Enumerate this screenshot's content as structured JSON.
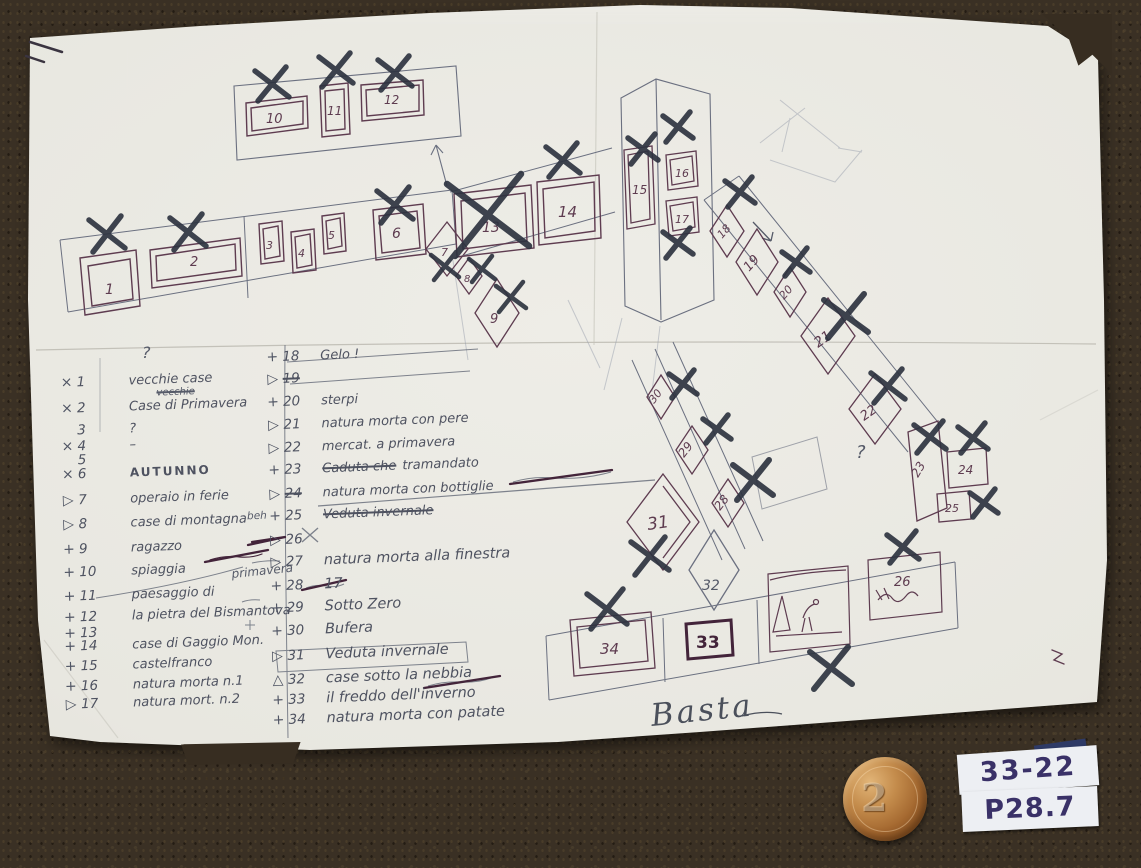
{
  "notes": {
    "q1": "?",
    "q2": "?",
    "primavera": "primavera",
    "basta": "Basta"
  },
  "coin": {
    "value": "2"
  },
  "corner_sticker": {
    "line1": "33-22",
    "line2": "P28.7"
  },
  "left_list": {
    "items": [
      {
        "mark": "×",
        "num": "1",
        "text": "vecchie case"
      },
      {
        "mark": "×",
        "num": "2",
        "text": "Case di Primavera",
        "note_above": "vecchie"
      },
      {
        "mark": "",
        "num": "3",
        "text": "?"
      },
      {
        "mark": "×",
        "num": "4",
        "text": "–"
      },
      {
        "mark": "",
        "num": "5",
        "text": ""
      },
      {
        "mark": "×",
        "num": "6",
        "text": "AUTUNNO"
      },
      {
        "mark": "▷",
        "num": "7",
        "text": "operaio in ferie"
      },
      {
        "mark": "▷",
        "num": "8",
        "text": "case di montagna"
      },
      {
        "mark": "+",
        "num": "9",
        "text": "ragazzo"
      },
      {
        "mark": "+",
        "num": "10",
        "text": "spiaggia"
      },
      {
        "mark": "+",
        "num": "11",
        "text": "paesaggio di"
      },
      {
        "mark": "+",
        "num": "12",
        "text": "la pietra del Bismantova"
      },
      {
        "mark": "+",
        "num": "13",
        "text": ""
      },
      {
        "mark": "+",
        "num": "14",
        "text": "case di Gaggio Mon."
      },
      {
        "mark": "+",
        "num": "15",
        "text": "castelfranco"
      },
      {
        "mark": "+",
        "num": "16",
        "text": "natura morta n.1"
      },
      {
        "mark": "▷",
        "num": "17",
        "text": "natura mort. n.2"
      }
    ]
  },
  "middle_list": {
    "items": [
      {
        "mark": "+",
        "num": "18",
        "text": "Gelo !"
      },
      {
        "mark": "▷",
        "num": "19",
        "text": "",
        "struck": true
      },
      {
        "mark": "+",
        "num": "20",
        "text": "sterpi"
      },
      {
        "mark": "▷",
        "num": "21",
        "text": "natura morta con pere"
      },
      {
        "mark": "▷",
        "num": "22",
        "text": "mercat. a primavera"
      },
      {
        "mark": "+",
        "num": "23",
        "text": "tramandato",
        "crossed_prefix": "Caduta che"
      },
      {
        "mark": "▷",
        "num": "24",
        "text": "natura morta con bottiglie",
        "num_struck": true
      },
      {
        "mark": "+",
        "num": "25",
        "text": "Veduta invernale",
        "struck": true,
        "note_left": "beh"
      },
      {
        "mark": "▷",
        "num": "26",
        "text": ""
      },
      {
        "mark": "▷",
        "num": "27",
        "text": "natura morta alla finestra"
      },
      {
        "mark": "+",
        "num": "28",
        "text": "17"
      },
      {
        "mark": "+",
        "num": "29",
        "text": "Sotto Zero"
      },
      {
        "mark": "+",
        "num": "30",
        "text": "Bufera"
      },
      {
        "mark": "▷",
        "num": "31",
        "text": "Veduta invernale",
        "boxed": true
      },
      {
        "mark": "△",
        "num": "32",
        "text": "case sotto la nebbia"
      },
      {
        "mark": "+",
        "num": "33",
        "text": "il freddo dell'inverno"
      },
      {
        "mark": "+",
        "num": "34",
        "text": "natura morta con patate"
      }
    ]
  },
  "frames": {
    "f1": "1",
    "f2": "2",
    "f3": "3",
    "f4": "4",
    "f5": "5",
    "f6": "6",
    "f7": "7",
    "f8": "8",
    "f9": "9",
    "f10": "10",
    "f11": "11",
    "f12": "12",
    "f13": "13",
    "f14": "14",
    "f15": "15",
    "f16": "16",
    "f17": "17",
    "f18": "18",
    "f19": "19",
    "f20": "20",
    "f21": "21",
    "f22": "22",
    "f23": "23",
    "f24": "24",
    "f25": "25",
    "f26": "26",
    "f28": "28",
    "f29": "29",
    "f30": "30",
    "f31": "31",
    "f32": "32",
    "f33": "33",
    "f34": "34"
  }
}
